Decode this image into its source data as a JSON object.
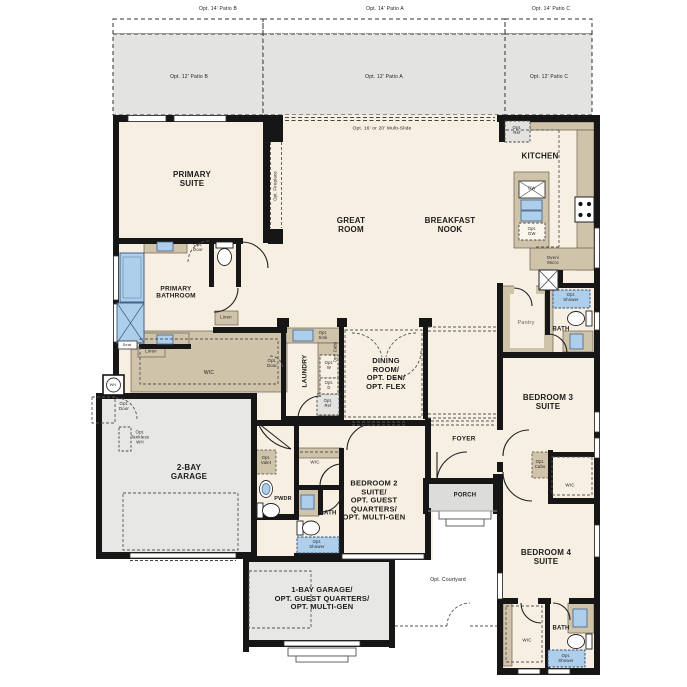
{
  "plan": {
    "title": "Single-story floor plan",
    "colors": {
      "wall": "#161616",
      "interior": "#f7efe2",
      "patio": "#e3e3e1",
      "garage": "#e7e7e5",
      "porch": "#dcdcda",
      "cabinet": "#cfc3aa",
      "fixture_blue": "#aecfeb"
    },
    "labels": [
      {
        "id": "patio14b",
        "text": "Opt. 14' Patio B",
        "x": 218,
        "y": 10,
        "size": 5
      },
      {
        "id": "patio14a",
        "text": "Opt. 14' Patio A",
        "x": 385,
        "y": 10,
        "size": 5
      },
      {
        "id": "patio14c",
        "text": "Opt. 14' Patio C",
        "x": 551,
        "y": 10,
        "size": 5
      },
      {
        "id": "patio12b",
        "text": "Opt. 12' Patio B",
        "x": 189,
        "y": 78,
        "size": 5
      },
      {
        "id": "patio12a",
        "text": "Opt. 12' Patio A",
        "x": 384,
        "y": 78,
        "size": 5
      },
      {
        "id": "patio12c",
        "text": "Opt. 12' Patio C",
        "x": 549,
        "y": 78,
        "size": 5
      },
      {
        "id": "multi-slide",
        "text": "Opt. 16' or 20' Multi-Slide",
        "x": 382,
        "y": 129,
        "size": 4.8
      },
      {
        "id": "opt-ref-kitchen",
        "text": "Opt.\nRef",
        "x": 517,
        "y": 131,
        "size": 4.3
      },
      {
        "id": "kitchen",
        "text": "KITCHEN",
        "x": 540,
        "y": 156,
        "size": 8,
        "bold": true
      },
      {
        "id": "primary-suite",
        "text": "PRIMARY\nSUITE",
        "x": 192,
        "y": 179,
        "size": 8,
        "bold": true
      },
      {
        "id": "great-room",
        "text": "GREAT\nROOM",
        "x": 351,
        "y": 225,
        "size": 8,
        "bold": true
      },
      {
        "id": "breakfast-nook",
        "text": "BREAKFAST\nNOOK",
        "x": 450,
        "y": 225,
        "size": 8,
        "bold": true
      },
      {
        "id": "opt-fireplace",
        "text": "Opt. Fireplace",
        "x": 276,
        "y": 186,
        "size": 4.3,
        "rotate": -90
      },
      {
        "id": "dw",
        "text": "DW",
        "x": 532,
        "y": 189,
        "size": 4.2
      },
      {
        "id": "opt-dw",
        "text": "Opt.\nDW",
        "x": 532,
        "y": 232,
        "size": 4.2
      },
      {
        "id": "oven-micro",
        "text": "Oven/\nMicro",
        "x": 553,
        "y": 261,
        "size": 4.3
      },
      {
        "id": "opt-door-bath",
        "text": "Opt.\nDoor",
        "x": 198,
        "y": 248,
        "size": 4.3
      },
      {
        "id": "primary-bathroom",
        "text": "PRIMARY\nBATHROOM",
        "x": 176,
        "y": 293,
        "size": 6.5,
        "bold": true
      },
      {
        "id": "linen-1",
        "text": "Linen",
        "x": 226,
        "y": 318,
        "size": 4.3
      },
      {
        "id": "seat",
        "text": "Seat",
        "x": 127,
        "y": 345,
        "size": 3.9
      },
      {
        "id": "linen-2",
        "text": "Linen",
        "x": 151,
        "y": 352,
        "size": 4.3
      },
      {
        "id": "opt-sink",
        "text": "Opt.\nSink",
        "x": 323,
        "y": 336,
        "size": 4.2
      },
      {
        "id": "opt-cabs-laundry",
        "text": "Opt. Cabs",
        "x": 336,
        "y": 352,
        "size": 4.2,
        "rotate": -90
      },
      {
        "id": "laundry",
        "text": "LAUNDRY",
        "x": 305,
        "y": 371,
        "size": 6.5,
        "bold": true,
        "rotate": -90
      },
      {
        "id": "opt-w",
        "text": "Opt.\nW",
        "x": 329,
        "y": 366,
        "size": 4.2
      },
      {
        "id": "opt-d",
        "text": "Opt.\nD",
        "x": 329,
        "y": 386,
        "size": 4.2
      },
      {
        "id": "opt-ref-laundry",
        "text": "Opt.\nRef",
        "x": 328,
        "y": 404,
        "size": 4.2
      },
      {
        "id": "opt-door-wic",
        "text": "Opt.\nDoor",
        "x": 272,
        "y": 364,
        "size": 4.3
      },
      {
        "id": "wic-primary",
        "text": "WIC",
        "x": 209,
        "y": 374,
        "size": 5
      },
      {
        "id": "dining",
        "text": "DINING\nROOM/\nOPT. DEN/\nOPT. FLEX",
        "x": 386,
        "y": 374,
        "size": 7.5,
        "bold": true
      },
      {
        "id": "pantry",
        "text": "Pantry",
        "x": 526,
        "y": 323,
        "size": 5.5,
        "color": "#666666"
      },
      {
        "id": "opt-shower-bath3",
        "text": "Opt.\nShower",
        "x": 571,
        "y": 298,
        "size": 4.2
      },
      {
        "id": "bath3",
        "text": "BATH",
        "x": 561,
        "y": 330,
        "size": 6,
        "bold": true
      },
      {
        "id": "bedroom3",
        "text": "BEDROOM 3\nSUITE",
        "x": 548,
        "y": 402,
        "size": 8,
        "bold": true
      },
      {
        "id": "wh",
        "text": "WH",
        "x": 113,
        "y": 385,
        "size": 3.8
      },
      {
        "id": "opt-door-garage",
        "text": "Opt.\nDoor",
        "x": 124,
        "y": 407,
        "size": 4.3
      },
      {
        "id": "opt-tankless-wh",
        "text": "Opt.\nTankless\nWH",
        "x": 140,
        "y": 438,
        "size": 4.3
      },
      {
        "id": "garage-2bay",
        "text": "2-BAY\nGARAGE",
        "x": 189,
        "y": 472,
        "size": 8,
        "bold": true
      },
      {
        "id": "foyer",
        "text": "FOYER",
        "x": 464,
        "y": 439,
        "size": 6.5,
        "bold": true
      },
      {
        "id": "opt-cabs-bed3",
        "text": "Opt.\nCabs",
        "x": 540,
        "y": 465,
        "size": 4.2
      },
      {
        "id": "wic-bed3",
        "text": "WIC",
        "x": 570,
        "y": 485,
        "size": 4.5
      },
      {
        "id": "opt-valet",
        "text": "Opt.\nValet",
        "x": 266,
        "y": 461,
        "size": 4.2
      },
      {
        "id": "wic-bed2",
        "text": "WIC",
        "x": 315,
        "y": 462,
        "size": 4.5
      },
      {
        "id": "bedroom2",
        "text": "BEDROOM 2\nSUITE/\nOPT. GUEST\nQUARTERS/\nOPT. MULTI-GEN",
        "x": 374,
        "y": 501,
        "size": 7.5,
        "bold": true
      },
      {
        "id": "pwdr",
        "text": "PWDR",
        "x": 283,
        "y": 499,
        "size": 5.5,
        "bold": true
      },
      {
        "id": "bath2",
        "text": "BATH",
        "x": 328,
        "y": 514,
        "size": 6,
        "bold": true
      },
      {
        "id": "porch",
        "text": "PORCH",
        "x": 465,
        "y": 496,
        "size": 6,
        "bold": true
      },
      {
        "id": "opt-shower-bath2",
        "text": "Opt.\nShower",
        "x": 317,
        "y": 545,
        "size": 4.2
      },
      {
        "id": "bedroom4",
        "text": "BEDROOM 4\nSUITE",
        "x": 546,
        "y": 557,
        "size": 8,
        "bold": true
      },
      {
        "id": "garage-1bay",
        "text": "1-BAY GARAGE/\nOPT. GUEST QUARTERS/\nOPT. MULTI-GEN",
        "x": 322,
        "y": 599,
        "size": 7.5,
        "bold": true
      },
      {
        "id": "opt-courtyard",
        "text": "Opt. Courtyard",
        "x": 448,
        "y": 581,
        "size": 5
      },
      {
        "id": "wic-bed4",
        "text": "WIC",
        "x": 527,
        "y": 640,
        "size": 4.5
      },
      {
        "id": "bath4",
        "text": "BATH",
        "x": 561,
        "y": 629,
        "size": 6,
        "bold": true
      },
      {
        "id": "opt-shower-bath4",
        "text": "Opt.\nShower",
        "x": 566,
        "y": 659,
        "size": 4.2
      }
    ]
  }
}
